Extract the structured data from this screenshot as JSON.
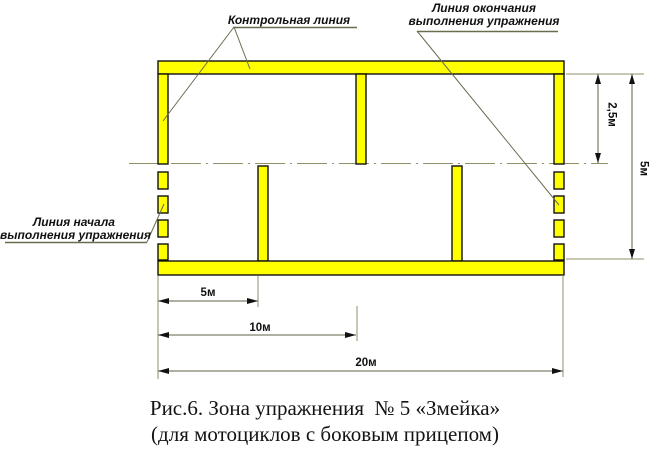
{
  "figure": {
    "labels": {
      "control_line": "Контрольная линия",
      "finish_line_1": "Линия окончания",
      "finish_line_2": "выполнения упражнения",
      "start_line_1": "Линия начала",
      "start_line_2": "выполнения упражнения"
    },
    "dimensions": {
      "gate_depth": "2,5м",
      "zone_width": "5м",
      "first_gate_offset": "5м",
      "second_gate_offset": "10м",
      "zone_length": "20м"
    },
    "caption_line1": "Рис.6. Зона упражнения  № 5 «Змейка»",
    "caption_line2": "(для мотоциклов с боковым прицепом)",
    "colors": {
      "marking": "#ffff00",
      "outline": "#111111",
      "dim_line": "#5f5f49",
      "ext_line": "#8f8f68",
      "text": "#111111"
    }
  }
}
